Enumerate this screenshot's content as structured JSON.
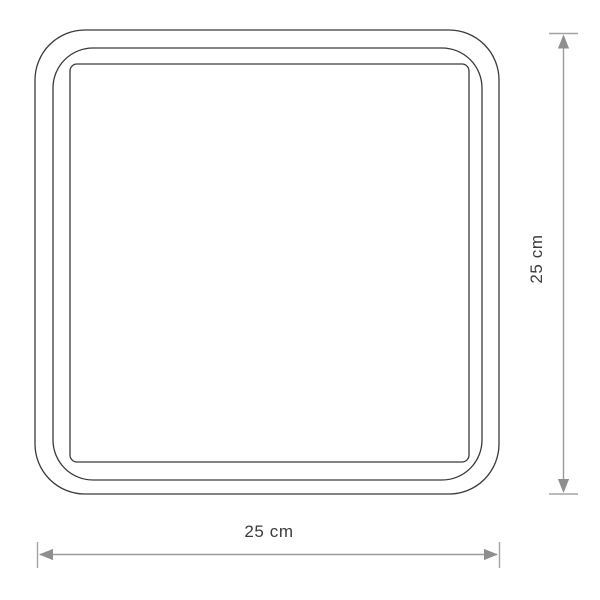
{
  "page": {
    "background": "#ffffff"
  },
  "diagram": {
    "kind": "product-dimension-drawing",
    "subject": "square ceiling lamp, front view with three nested frame outlines",
    "colors": {
      "outline": "#3a3a3a",
      "dimension_line": "#9b9b9b",
      "arrowhead": "#8e8e8e",
      "extension_cap": "#a3a3a3",
      "label_text": "#3c3c3c"
    },
    "dimensions": {
      "height": {
        "label": "25 cm",
        "value": 25,
        "unit": "cm",
        "orientation": "vertical",
        "side": "right"
      },
      "width": {
        "label": "25 cm",
        "value": 25,
        "unit": "cm",
        "orientation": "horizontal",
        "side": "bottom"
      }
    }
  }
}
